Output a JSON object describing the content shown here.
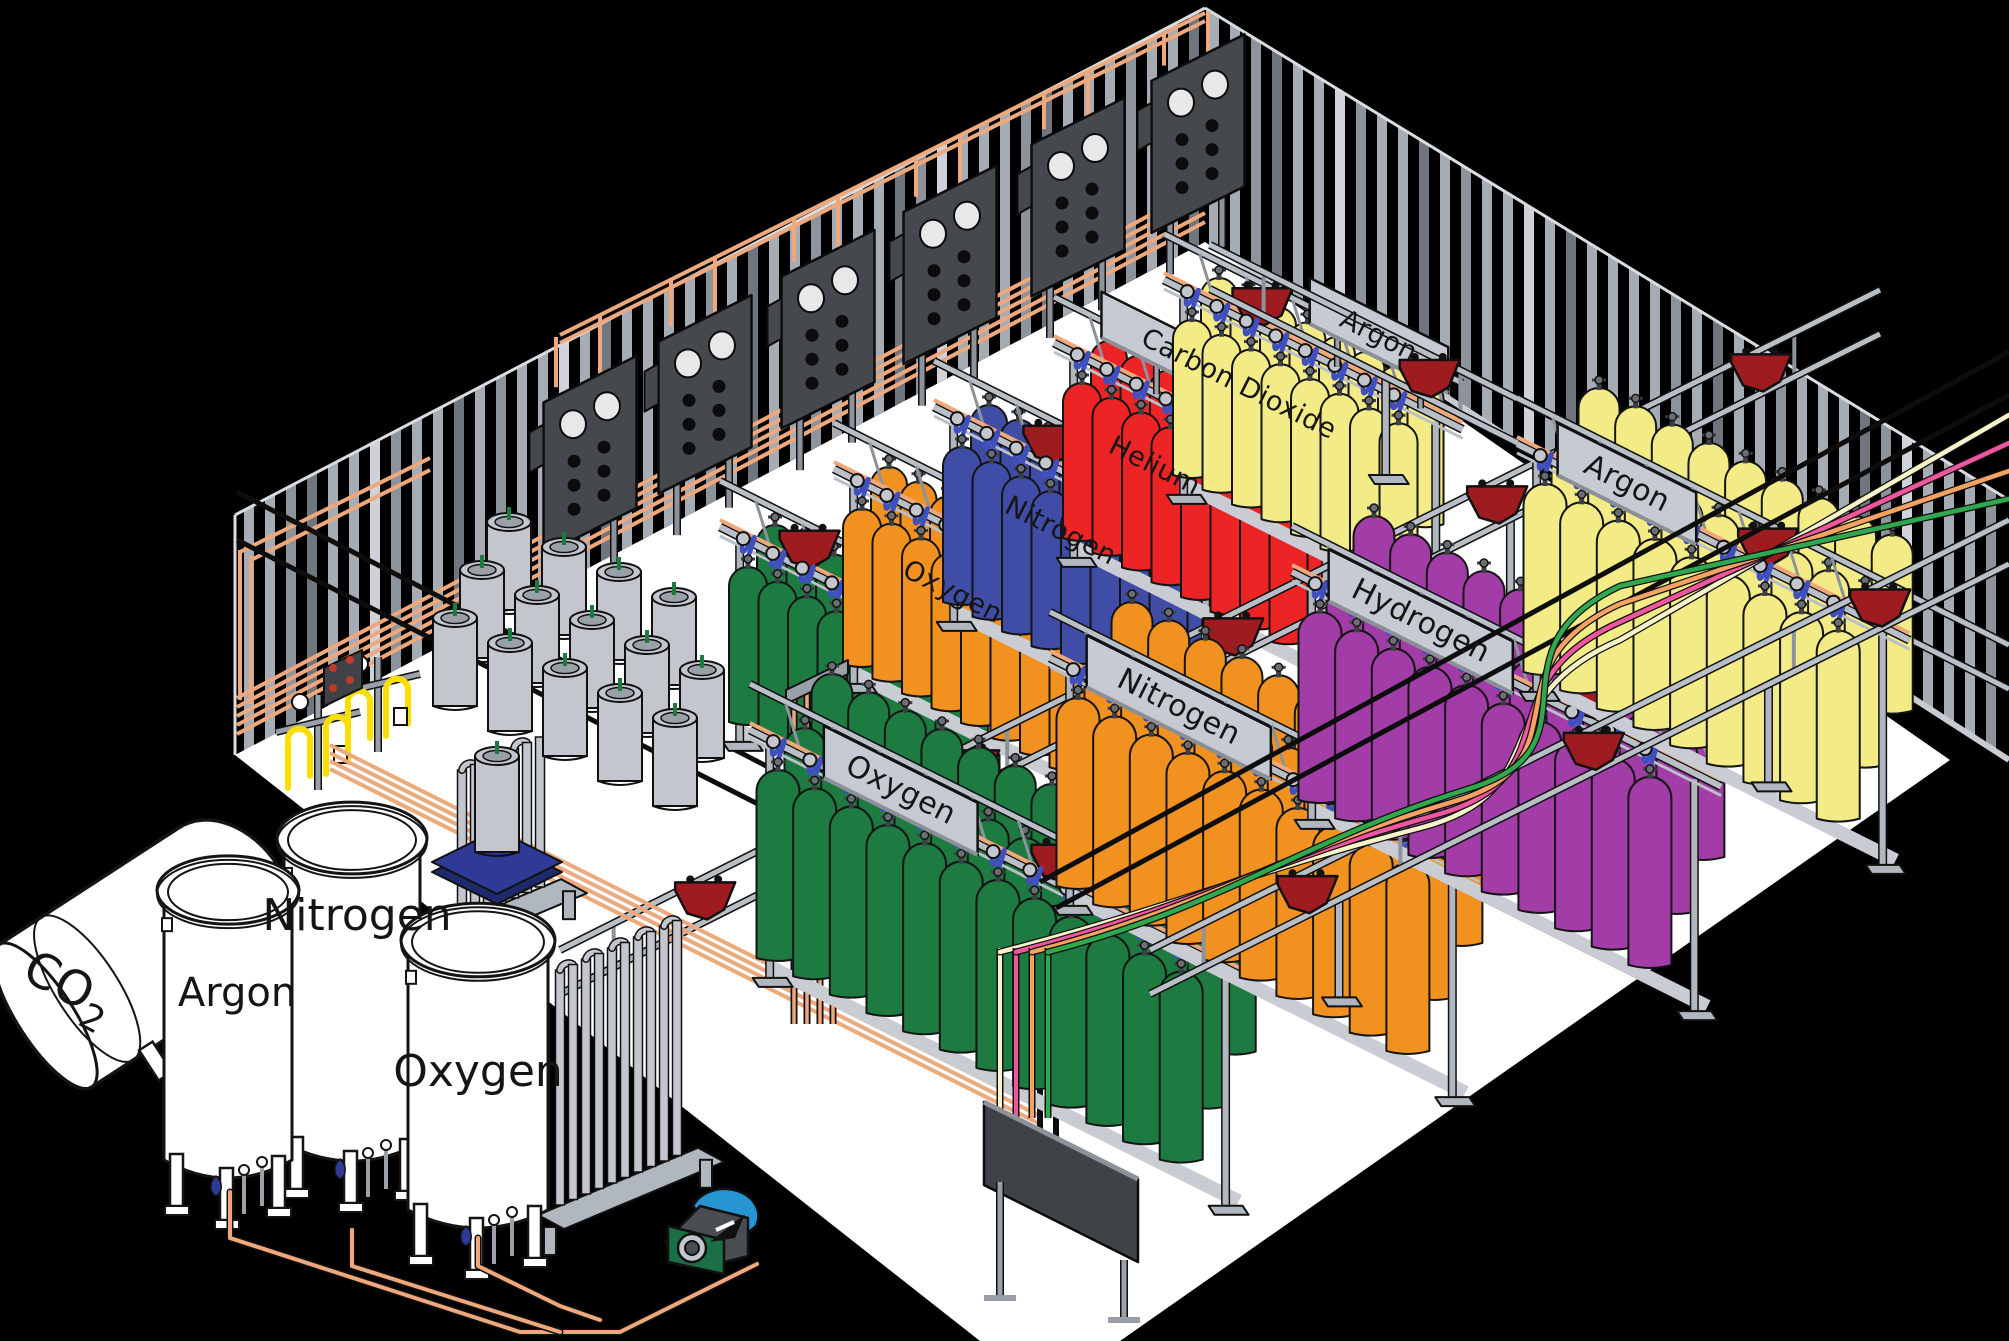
{
  "scene": {
    "width": 2009,
    "height": 1341,
    "background": "#000000",
    "floor_color": "#ffffff",
    "wall": {
      "stripe": "#a6acb4",
      "stripe_mid": "#8d939b",
      "stripe_dark": "#70767e",
      "stripe_light": "#cfd3d9",
      "edge": "#d9dde1"
    }
  },
  "storage_tanks": [
    {
      "id": "co2",
      "label_main": "CO",
      "label_sub": "2"
    },
    {
      "id": "argon",
      "label": "Argon"
    },
    {
      "id": "nitrogen",
      "label": "Nitrogen"
    },
    {
      "id": "oxygen",
      "label": "Oxygen"
    }
  ],
  "stations": {
    "back": [
      {
        "label": "Oxygen",
        "color": "#1d7a40",
        "origin": [
          748,
          722
        ],
        "count": 8,
        "rows": 2,
        "sign_t": 0.78,
        "cart_t": 0.3
      },
      {
        "label": "Nitrogen",
        "color": "#f1911f",
        "origin": [
          862,
          664
        ],
        "count": 8,
        "rows": 2,
        "sign_t": 0.76,
        "cart_t": 0.55
      },
      {
        "label": "Helium",
        "color": "#3f4da6",
        "origin": [
          962,
          602
        ],
        "count": 8,
        "rows": 2,
        "sign_t": 0.74,
        "cart_t": 0.4
      },
      {
        "label": "Carbon Dioxide",
        "color": "#ec2426",
        "origin": [
          1082,
          538
        ],
        "count": 8,
        "rows": 2,
        "sign_t": 0.62,
        "cart_t": 0.82
      },
      {
        "label": "Argon",
        "color": "#f3ec86",
        "origin": [
          1192,
          475
        ],
        "count": 8,
        "rows": 2,
        "sign_t": 0.72,
        "cart_t": 0.33
      }
    ],
    "front": [
      {
        "label": "Oxygen",
        "color": "#1d7a40",
        "origin": [
          778,
          958
        ],
        "count": 12,
        "rows": 3,
        "sign_t": 0.3,
        "cart_t": 0.62
      },
      {
        "label": "Nitrogen",
        "color": "#f1911f",
        "origin": [
          1078,
          886
        ],
        "count": 10,
        "rows": 3,
        "sign_t": 0.3,
        "cart_t": 0.66
      },
      {
        "label": "Hydrogen",
        "color": "#a23ca6",
        "origin": [
          1320,
          800
        ],
        "count": 10,
        "rows": 3,
        "sign_t": 0.3,
        "cart_t": 0.7
      },
      {
        "label": "Argon",
        "color": "#f3ec86",
        "origin": [
          1545,
          672
        ],
        "count": 9,
        "rows": 3,
        "sign_t": 0.28,
        "cart_t": 0.64
      }
    ]
  },
  "cart_rails": [
    {
      "from": [
        560,
        950
      ],
      "to": [
        1880,
        290
      ],
      "carts": 5
    },
    {
      "from": [
        1150,
        950
      ],
      "to": [
        2009,
        520
      ],
      "carts": 3
    },
    {
      "from": [
        1210,
        245
      ],
      "to": [
        2009,
        645
      ],
      "carts": 2
    }
  ],
  "supply_lines": [
    {
      "name": "cream",
      "color": "#f7f3c8"
    },
    {
      "name": "pink",
      "color": "#f0569e"
    },
    {
      "name": "salmon",
      "color": "#f5a263"
    },
    {
      "name": "green",
      "color": "#2fa84e"
    }
  ],
  "pipes": {
    "copper": "#efa87c",
    "yellow": "#f8df00",
    "black": "#0d0d0d",
    "hose_blue": "#3f4fbe"
  },
  "carts": {
    "color": "#9e1b20",
    "rail_color": "#b9bfc7"
  },
  "equipment": {
    "wall_panel_color": "#45494d",
    "wall_panel_count": 6,
    "dewar_color": "#c3c7cd",
    "pallet_color": "#2e3a96",
    "sign_color": "#c6cad2",
    "pump": {
      "body": "#4a4e52",
      "scroll": "#2596d2",
      "housing": "#1b6f46"
    }
  }
}
